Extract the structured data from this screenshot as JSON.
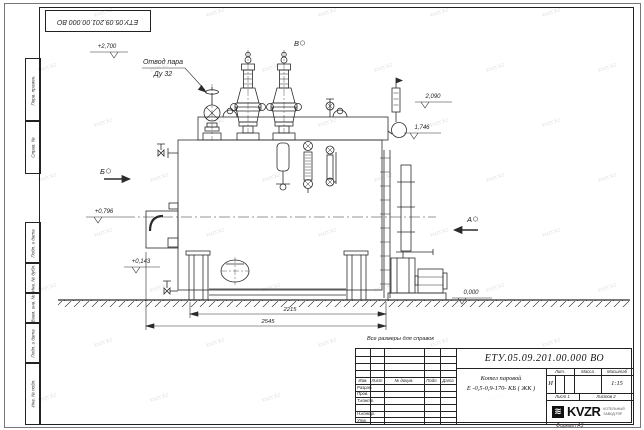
{
  "sheet": {
    "doc_number": "ЕТУ.05.09.201.00.000 ВО",
    "format_note": "Формат А3",
    "reference_note": "Все размеры для справок",
    "watermark": "kvzr.kz"
  },
  "margin_labels": [
    "Перв. примен.",
    "Справ. №",
    "Подп. и дата",
    "Инв. № дубл.",
    "Взам. инв. №",
    "Подп. и дата",
    "Инв. № подл."
  ],
  "drawing": {
    "callout": {
      "line1": "Отвод пара",
      "line2": "Ду 32"
    },
    "views": {
      "a": "А",
      "b": "Б",
      "v": "В"
    },
    "elevations": {
      "top": "+2,700",
      "e2090": "2,090",
      "e1746": "1,746",
      "e0796": "+0,796",
      "e0143": "+0,143",
      "zero": "0,000"
    },
    "dimensions": {
      "d1": "2215",
      "d2": "2545"
    }
  },
  "title_block": {
    "doc_number": "ЕТУ.05.09.201.00.000  ВО",
    "name_line1": "Котел паровой",
    "name_line2": "Е -0,5-0,9-170- КБ ( ЖК )",
    "headers": {
      "izm": "Изм.",
      "list": "Лист",
      "ndocum": "№ докум.",
      "podp": "Подп.",
      "data": "Дата",
      "lit": "Лит.",
      "massa": "Масса",
      "masshtab": "Масштаб",
      "list_no": "Лист 1",
      "listov": "Листов 2"
    },
    "rows": [
      "Разраб.",
      "Пров.",
      "Т.контр.",
      "",
      "Н.контр.",
      "Утв."
    ],
    "lit_value": "И",
    "scale": "1:15",
    "logo_text": "KVZR",
    "logo_glyph": "≋",
    "logo_sub1": "КОТЕЛЬНЫЙ",
    "logo_sub2": "ЗАВОД РЗР"
  }
}
